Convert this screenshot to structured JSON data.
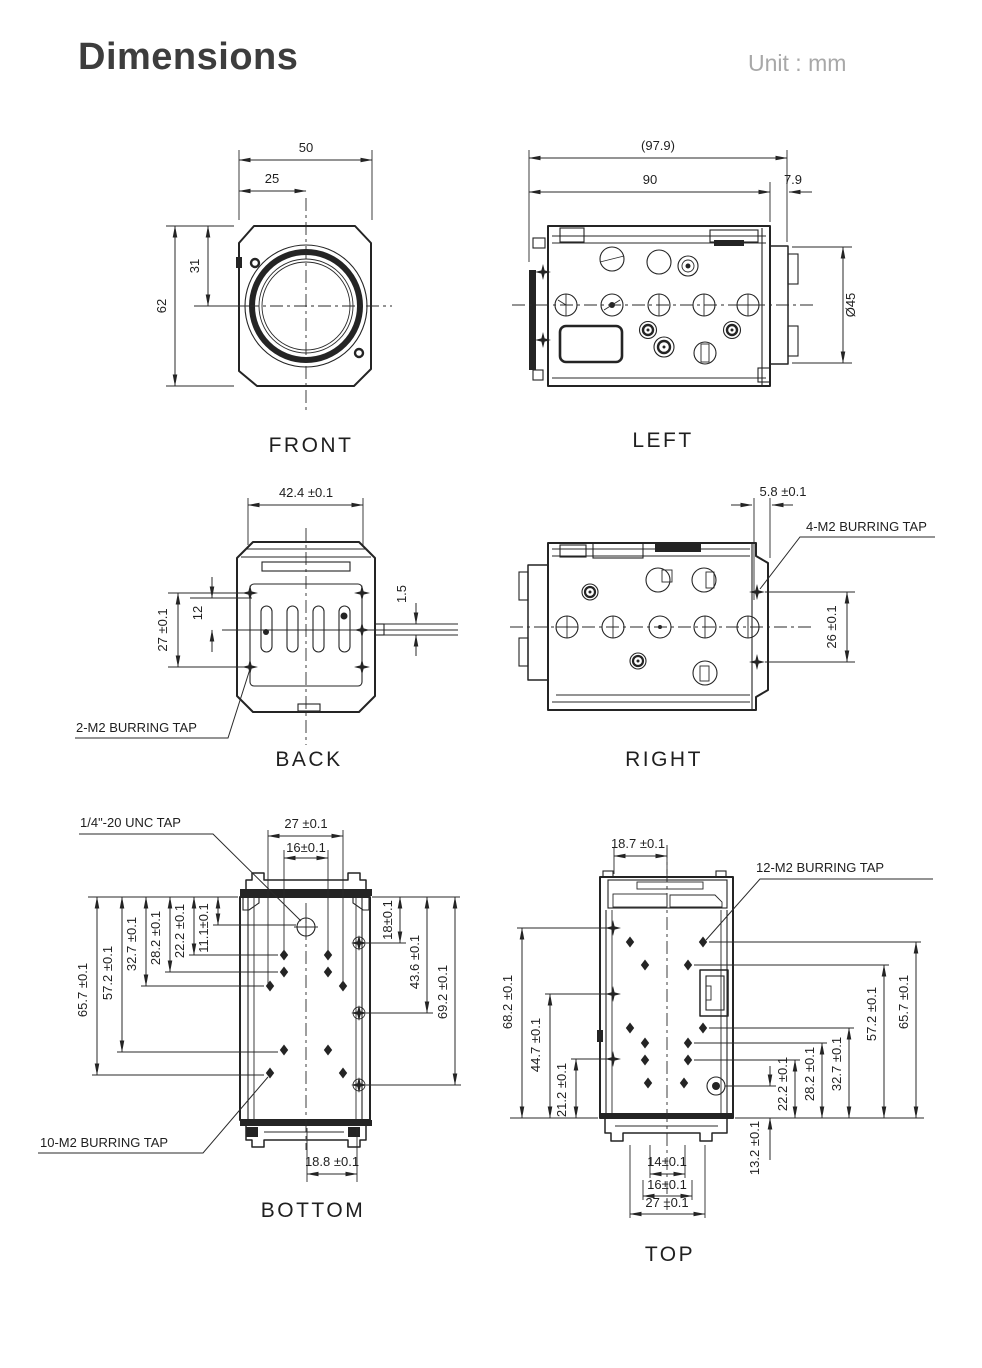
{
  "page": {
    "title": "Dimensions",
    "unit_label": "Unit : mm"
  },
  "views": {
    "front": {
      "label": "FRONT",
      "dims": {
        "width": "50",
        "half_width": "25",
        "center_offset": "31",
        "height": "62"
      }
    },
    "left": {
      "label": "LEFT",
      "dims": {
        "overall_depth": "(97.9)",
        "body_depth": "90",
        "lens_protrusion": "7.9",
        "lens_diameter": "Ø45"
      }
    },
    "back": {
      "label": "BACK",
      "dims": {
        "width": "42.4 ±0.1",
        "slot_offset": "12",
        "tap_spacing": "27 ±0.1",
        "protrusion": "1.5"
      },
      "notes": {
        "tap": "2-M2 BURRING TAP"
      }
    },
    "right": {
      "label": "RIGHT",
      "dims": {
        "tap_offset": "5.8 ±0.1",
        "tap_spacing": "26 ±0.1"
      },
      "notes": {
        "tap": "4-M2 BURRING TAP"
      }
    },
    "bottom": {
      "label": "BOTTOM",
      "dims": {
        "d27": "27 ±0.1",
        "d16": "16±0.1",
        "d65_7": "65.7 ±0.1",
        "d57_2": "57.2 ±0.1",
        "d32_7": "32.7 ±0.1",
        "d28_2": "28.2 ±0.1",
        "d22_2": "22.2 ±0.1",
        "d11_1": "11.1±0.1",
        "d18": "18±0.1",
        "d43_6": "43.6 ±0.1",
        "d69_2": "69.2 ±0.1",
        "d18_8": "18.8 ±0.1"
      },
      "notes": {
        "unc_tap": "1/4\"-20 UNC TAP",
        "tap": "10-M2 BURRING TAP"
      }
    },
    "top": {
      "label": "TOP",
      "dims": {
        "d18_7": "18.7 ±0.1",
        "d68_2": "68.2 ±0.1",
        "d44_7": "44.7 ±0.1",
        "d21_2": "21.2 ±0.1",
        "d65_7": "65.7 ±0.1",
        "d57_2": "57.2 ±0.1",
        "d32_7": "32.7 ±0.1",
        "d28_2": "28.2 ±0.1",
        "d22_2": "22.2 ±0.1",
        "d13_2": "13.2 ±0.1",
        "d14": "14±0.1",
        "d16": "16±0.1",
        "d27": "27 ±0.1"
      },
      "notes": {
        "tap": "12-M2 BURRING TAP"
      }
    }
  },
  "colors": {
    "line": "#242424",
    "title": "#3d3d3d",
    "muted": "#a8a8a8"
  }
}
